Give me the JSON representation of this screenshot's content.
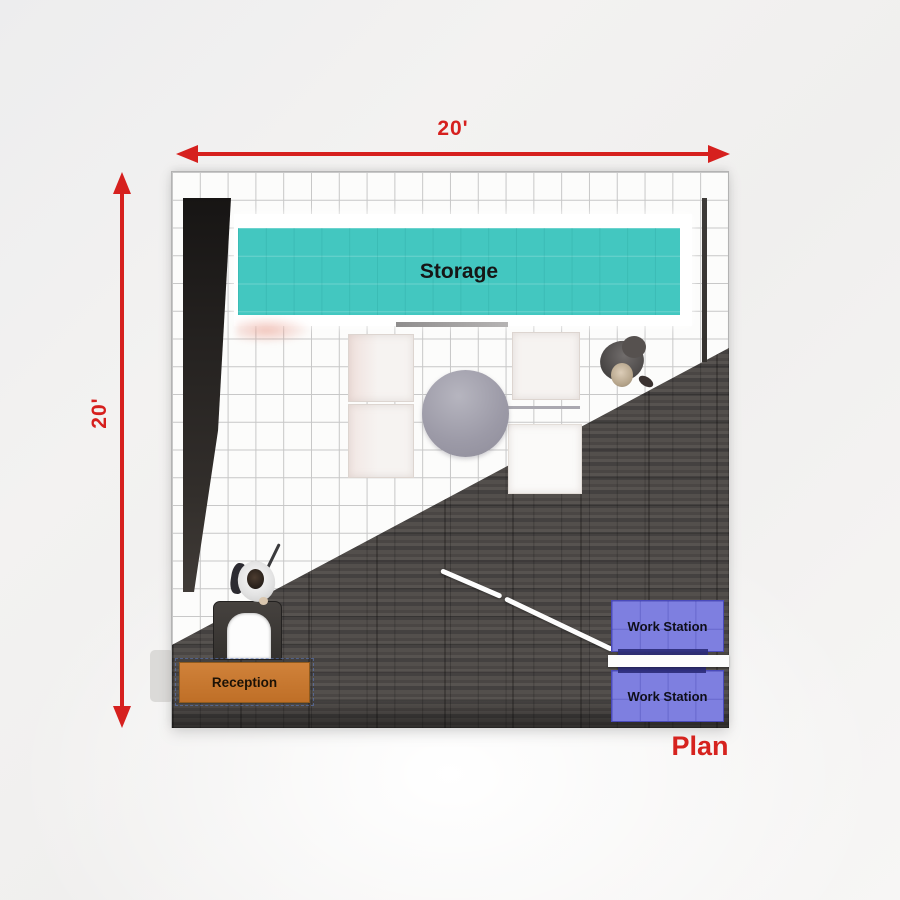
{
  "plan_caption": {
    "label": "Plan",
    "color": "#d6231f"
  },
  "dimensions": {
    "width": {
      "label": "20'",
      "color": "#d6201e"
    },
    "height": {
      "label": "20'",
      "color": "#d6201e"
    }
  },
  "areas": {
    "storage": {
      "label": "Storage",
      "color": "#43c7c0"
    },
    "reception": {
      "label": "Reception",
      "color": "#c8792f"
    }
  },
  "workstations": [
    {
      "label": "Work Station",
      "color": "#7e7fe0"
    },
    {
      "label": "Work Station",
      "color": "#7e7fe0"
    }
  ],
  "floor": {
    "grid_squares_per_side": 20,
    "grid_line_color": "#c7c7c7",
    "wood_color": "#4c4846",
    "wall_color": "#262321"
  },
  "figures": [
    {
      "name": "visitor",
      "location": "near storage, right side"
    },
    {
      "name": "receptionist",
      "location": "at reception arch"
    }
  ]
}
